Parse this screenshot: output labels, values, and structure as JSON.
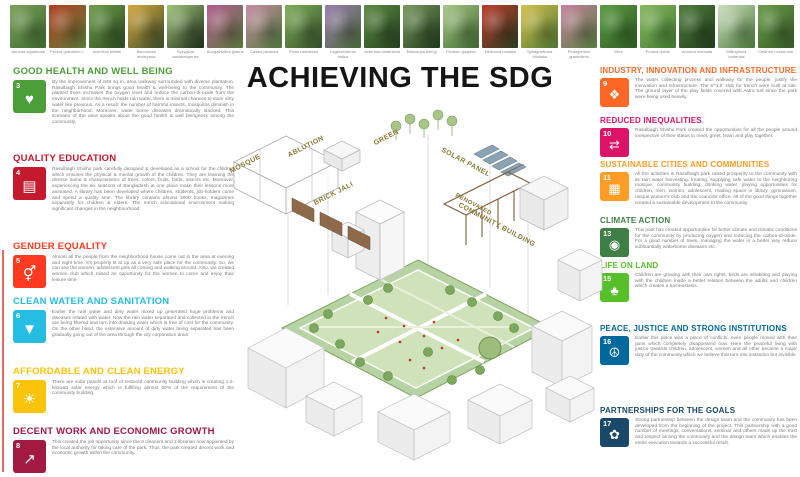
{
  "title": "ACHIEVING THE SDG",
  "plants": [
    {
      "label": "Annona squamosa",
      "c1": "#7aa05a",
      "c2": "#3f6b2e"
    },
    {
      "label": "Punica granatum L.",
      "c1": "#b43a1e",
      "c2": "#5c7f3a"
    },
    {
      "label": "Averrhoa bilimbi",
      "c1": "#6d9b4a",
      "c2": "#2e4d22"
    },
    {
      "label": "Baccaurea motleyana",
      "c1": "#d8a83c",
      "c2": "#3a4d2a"
    },
    {
      "label": "Syzygium samarangense",
      "c1": "#9fc57a",
      "c2": "#1f2d1a"
    },
    {
      "label": "Bougainvillea glabra",
      "c1": "#b55a8f",
      "c2": "#5a7a3f"
    },
    {
      "label": "Cassia javanica",
      "c1": "#c98aa5",
      "c2": "#4f7a3c"
    },
    {
      "label": "Ficus racemosa",
      "c1": "#7fae58",
      "c2": "#33512a"
    },
    {
      "label": "Lagerstroemia indica",
      "c1": "#9a7ab0",
      "c2": "#4a6b35"
    },
    {
      "label": "Averrhoa carambola",
      "c1": "#5d8a43",
      "c2": "#24421f"
    },
    {
      "label": "Mimusops elengi",
      "c1": "#7a9a5f",
      "c2": "#1d3a1a"
    },
    {
      "label": "Psidium guajava",
      "c1": "#a8c88a",
      "c2": "#3f6b2e"
    },
    {
      "label": "Heliconia rostrata",
      "c1": "#c03a2a",
      "c2": "#2a3f22"
    },
    {
      "label": "Sphagneticola trilobata",
      "c1": "#d8c04a",
      "c2": "#4f7a35"
    },
    {
      "label": "Pelargonium graveolens",
      "c1": "#c77fa0",
      "c2": "#57803f"
    },
    {
      "label": "Vitex",
      "c1": "#5a9a3f",
      "c2": "#2f5d24"
    },
    {
      "label": "Prunus dulcis",
      "c1": "#88b85f",
      "c2": "#3f7a2e"
    },
    {
      "label": "Annona muricata",
      "c1": "#4f7a3a",
      "c2": "#223f1d"
    },
    {
      "label": "Millingtonia hortensis",
      "c1": "#cfe0c0",
      "c2": "#4a7a38"
    },
    {
      "label": "Cestrum nocturnum",
      "c1": "#6a9a4a",
      "c2": "#365c28"
    }
  ],
  "left_goals": [
    {
      "num": "3",
      "color": "#4C9F38",
      "glyph": "♥",
      "icon": "heartbeat-icon",
      "heading": "GOOD HEALTH AND WELL BEING",
      "body": "By the improvement of 848 sq m. area walkway surrounded with diverse plantation, Rasulbagh Shishu Park brings good health & well-being to the community. The planted trees increases the oxygen level and reduce the carbon-di-oxide from the environment. Since the trench holds rain water, there is minimal chances to store dirty water like previous. As a result, the number of harmful insects, mosquitos diminish in the neighborhood. Moreover, water borne diseases dramatically slacked. This scenario of the area speaks about the good health & well beingness among the community."
    },
    {
      "num": "4",
      "color": "#C5192D",
      "glyph": "▤",
      "icon": "open-book-icon",
      "heading": "QUALITY EDUCATION",
      "body": "Rasulbagh Shishu park carefully designed & developed as a school for the children which ensures the physical & mental growth of the children. They are learning the diverse name & characteristics of trees, colors, fruits, birds, insects etc. Moreover, experiencing the six seasons of Bangladesh at one place make their lessons more animated. A library has been developed where children, students, job-holders come and spend a quality time. The library contains almost 3000 books, magazines separately for children & elders. The enrich educational environment making significant changes in the neighbourhood."
    },
    {
      "num": "5",
      "color": "#FF3A21",
      "glyph": "⚥",
      "icon": "gender-equality-icon",
      "heading": "GENDER EQUALITY",
      "body": "Almost all the people from the neighborhood house come out in the area at evening and night time. It's properly lit at up as a very safe place for the community. So, we can see the women, adolescent girls all coming and walking around. Also, we created women club which raised an opportunity for the women to come and enjoy their leisure time."
    },
    {
      "num": "6",
      "color": "#26BDE2",
      "glyph": "▼",
      "icon": "water-drop-icon",
      "heading": "CLEAN WATER AND SANITATION",
      "body": "Earlier the rain water and dirty water mixed up generated huge problems and diseases related with water. Now the rain water separated and collected in the trench are being filtered and turn into drinking water which is free of cost for the community. On the other hand, the extensive amount of dirty water being separated has been gradually going out of the area through the city corporation drain."
    },
    {
      "num": "7",
      "color": "#FCC30B",
      "glyph": "☀",
      "icon": "sun-icon",
      "heading": "AFFORDABLE AND CLEAN ENERGY",
      "body": "There are solar panels at roof of restored community building which is creating 1.2-kilowatt solar energy which is fulfilling almost 50% of the requirement of the community building."
    },
    {
      "num": "8",
      "color": "#A21942",
      "glyph": "↗",
      "icon": "growth-chart-icon",
      "heading": "DECENT WORK AND ECONOMIC GROWTH",
      "body": "This created the job opportunity since the 3 cleaners and 1 librarian now appointed by the local authority for taking care of the park. Thus, the park created decent work and economic growth within the community."
    }
  ],
  "right_goals": [
    {
      "num": "9",
      "color": "#FD6925",
      "glyph": "❖",
      "icon": "building-blocks-icon",
      "heading": "INDUSTRY, INNOVATION AND INFRASTRUCTURE",
      "body": "The water collecting process and walkway for the people, justify the innovation and infrastructure. The 6'*1.5' slab for trench were built at site. The ground layer of the play fields covered with Astro turf since the park were being used heavily."
    },
    {
      "num": "10",
      "color": "#DD1367",
      "glyph": "⇄",
      "icon": "equality-arrows-icon",
      "heading": "REDUCED INEQUALITIES",
      "body": "Rasulbagh Shishu Park created the opportunities for all the people around irrespective of their status to meet, greet, learn and play together."
    },
    {
      "num": "11",
      "color": "#FD9D24",
      "glyph": "▦",
      "icon": "city-skyline-icon",
      "heading": "SUSTAINABLE CITIES AND COMMUNITIES",
      "body": "All the activities in Rasulbagh park raised prosperity to the community with its rain water harvesting, treating, supplying safe water to the neighboring mosque, community building, drinking water, playing opportunities for children, men, women, adolescent, reading space in library, gymnasium, unique women's club and the councilor office. All of the good things together created a sustainable development to the community."
    },
    {
      "num": "13",
      "color": "#3F7E44",
      "glyph": "◉",
      "icon": "eye-globe-icon",
      "heading": "CLIMATE ACTION",
      "body": "This park has created opportunities for better climate and climatic conditions for the community by producing oxygen and reducing the carbon-di-oxide. For a good number of trees, managing the water in a better way reduce substantially waterborne diseases etc."
    },
    {
      "num": "15",
      "color": "#56C02B",
      "glyph": "♣",
      "icon": "tree-birds-icon",
      "heading": "LIFE ON LAND",
      "body": "Children are growing with their own rights, birds are inhabiting and playing with the children made a better relation between the adults and children which creates a homeostasis."
    },
    {
      "num": "16",
      "color": "#00689D",
      "glyph": "☮",
      "icon": "dove-gavel-icon",
      "heading": "PEACE, JUSTICE AND STRONG INSTITUTIONS",
      "body": "Earlier this place was a place of conflicts, even people moved with their guns which completely disappeared now. Here the peaceful living with justice towards children, adolescent, women and all other became a major duty of the community which we believe that turn into institution but invisible."
    },
    {
      "num": "17",
      "color": "#19486A",
      "glyph": "✿",
      "icon": "interlocking-circles-icon",
      "heading": "PARTNERSHIPS FOR THE GOALS",
      "body": "Strong partnership between the design team and the community has been developed from the beginning of the project. This partnership with a good number of meetings, conversations, seminar and others made up the trust and respect among the community and the design team which enables the entire execution towards a successful result."
    }
  ],
  "diagram": {
    "labels": [
      "MOSQUE",
      "ABLUTION",
      "BRICK JALI",
      "GREEN",
      "SOLAR PANEL",
      "RENOVATED",
      "COMMUNITY BUILDING"
    ]
  }
}
